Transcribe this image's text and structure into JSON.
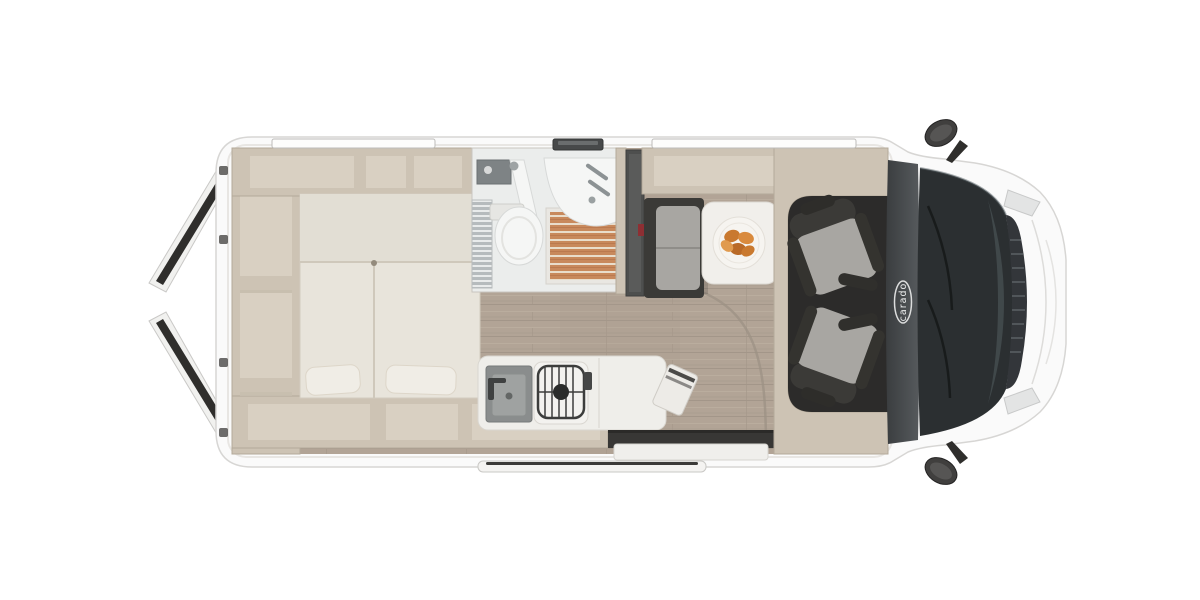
{
  "logo": {
    "text": "carado"
  },
  "palette": {
    "bg": "#ffffff",
    "body": "#fafafa",
    "body-line": "#d7d6d4",
    "wall": "#cdc3b4",
    "wall-line": "#b4aa9a",
    "wall-in": "#d9d0c2",
    "bed": "#e8e4db",
    "bed-top": "#e2ded4",
    "pillow": "#f0ede6",
    "floor": "#b2a496",
    "floor-line": "#9c9184",
    "bath": "#ebedec",
    "fixture": "#f5f6f5",
    "fixture-line": "#d7d9d8",
    "slat-wood": "#c8895c",
    "slat-gap": "#e9ddcb",
    "steel": "#8a8d8d",
    "dark": "#3b3a37",
    "cushion": "#a8a6a2",
    "cab-floor": "#2c2b2a",
    "dash": "#44474a",
    "glass": "#2b2f31",
    "grille": "#33363a",
    "grille-line": "#51565a",
    "accent-red": "#8e2f33",
    "food": "#c9792f"
  },
  "parts": [
    "rear-doors-open",
    "rear-storage-shelves",
    "rear-double-bed",
    "pillows",
    "bathroom",
    "toilet",
    "shower-tray",
    "washbasin",
    "wardrobe",
    "dinette-bench",
    "dinette-table",
    "breakfast-plate",
    "kitchen-counter",
    "kitchen-sink",
    "gas-hob",
    "entry-step",
    "sliding-door-step",
    "cab-swivel-seats",
    "dashboard",
    "carado-badge",
    "windshield",
    "front-grille",
    "side-mirrors",
    "roof-windows"
  ]
}
